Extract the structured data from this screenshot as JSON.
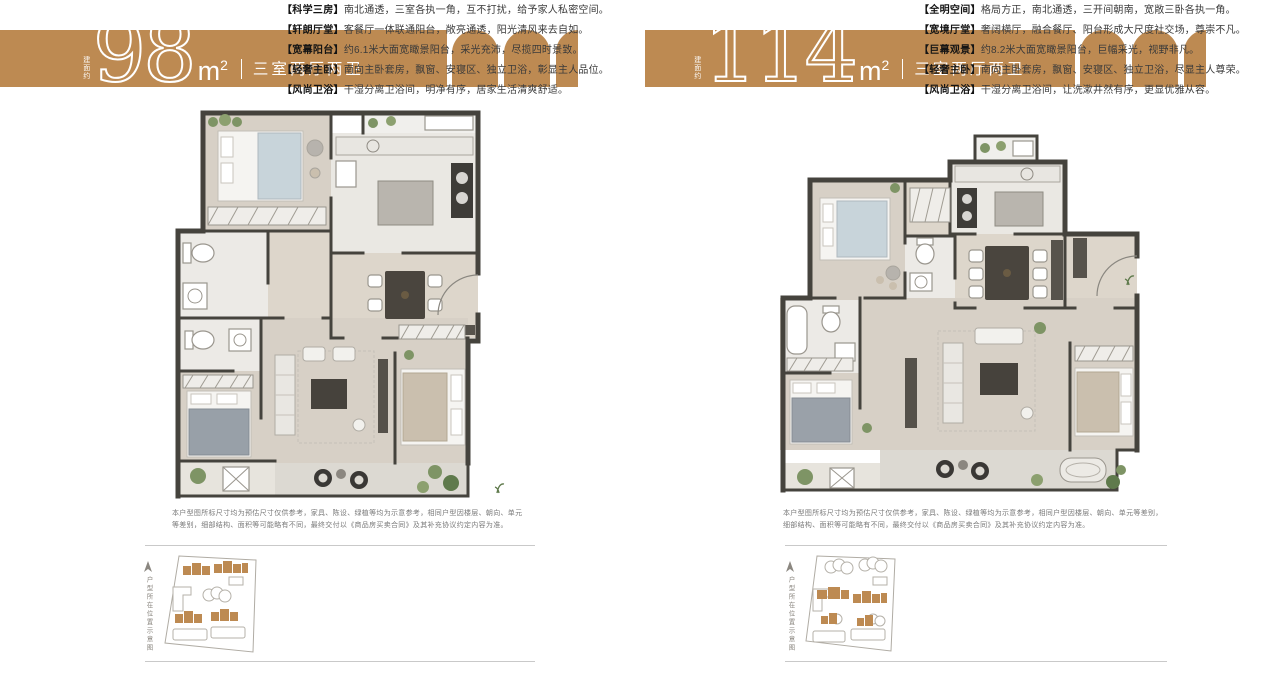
{
  "colors": {
    "accent": "#BD8A52",
    "wall": "#45433d",
    "divider": "#c9c9c9"
  },
  "left_unit": {
    "banner": {
      "area_prefix": "建面约",
      "area_number": "98",
      "area_unit_base": "m",
      "area_unit_sup": "2",
      "layout_label": "三室两厅两卫"
    },
    "disclaimer": "本户型图所标尺寸均为预估尺寸仅供参考，家具、陈设、绿植等均为示意参考，相同户型因楼层、朝向、单元等差别，细部结构、面积等可能略有不同，最终交付以《商品房买卖合同》及其补充协议约定内容为准。",
    "site_plan_caption": "户型所在位置示意图",
    "features": [
      {
        "tag": "【科学三房】",
        "text": "南北通透，三室各执一角，互不打扰，给予家人私密空间。"
      },
      {
        "tag": "【轩朗厅堂】",
        "text": "客餐厅一体联通阳台，敞亮通透，阳光清风来去自如。"
      },
      {
        "tag": "【宽幕阳台】",
        "text": "约6.1米大面宽瞰景阳台，采光充沛，尽揽四时景致。"
      },
      {
        "tag": "【轻奢主卧】",
        "text": "南向主卧套房，飘窗、安寝区、独立卫浴，彰显主人品位。"
      },
      {
        "tag": "【风尚卫浴】",
        "text": "干湿分离卫浴间，明净有序，居家生活清爽舒适。"
      }
    ]
  },
  "right_unit": {
    "banner": {
      "area_prefix": "建面约",
      "area_number": "114",
      "area_unit_base": "m",
      "area_unit_sup": "2",
      "layout_label": "三室两厅两卫"
    },
    "disclaimer": "本户型图所标尺寸均为预估尺寸仅供参考，家具、陈设、绿植等均为示意参考，相同户型因楼层、朝向、单元等差别，细部结构、面积等可能略有不同，最终交付以《商品房买卖合同》及其补充协议约定内容为准。",
    "site_plan_caption": "户型所在位置示意图",
    "features": [
      {
        "tag": "【全明空间】",
        "text": "格局方正，南北通透，三开间朝南，宽敞三卧各执一角。"
      },
      {
        "tag": "【宽境厅堂】",
        "text": "奢阔横厅，融合餐厅、阳台形成大尺度社交场，尊崇不凡。"
      },
      {
        "tag": "【巨幕观景】",
        "text": "约8.2米大面宽瞰景阳台，巨幅采光，视野非凡。"
      },
      {
        "tag": "【轻奢主卧】",
        "text": "南向主卧套房，飘窗、安寝区、独立卫浴，尽显主人尊荣。"
      },
      {
        "tag": "【风尚卫浴】",
        "text": "干湿分离卫浴间，让洗漱井然有序，更显优雅从容。"
      }
    ]
  }
}
